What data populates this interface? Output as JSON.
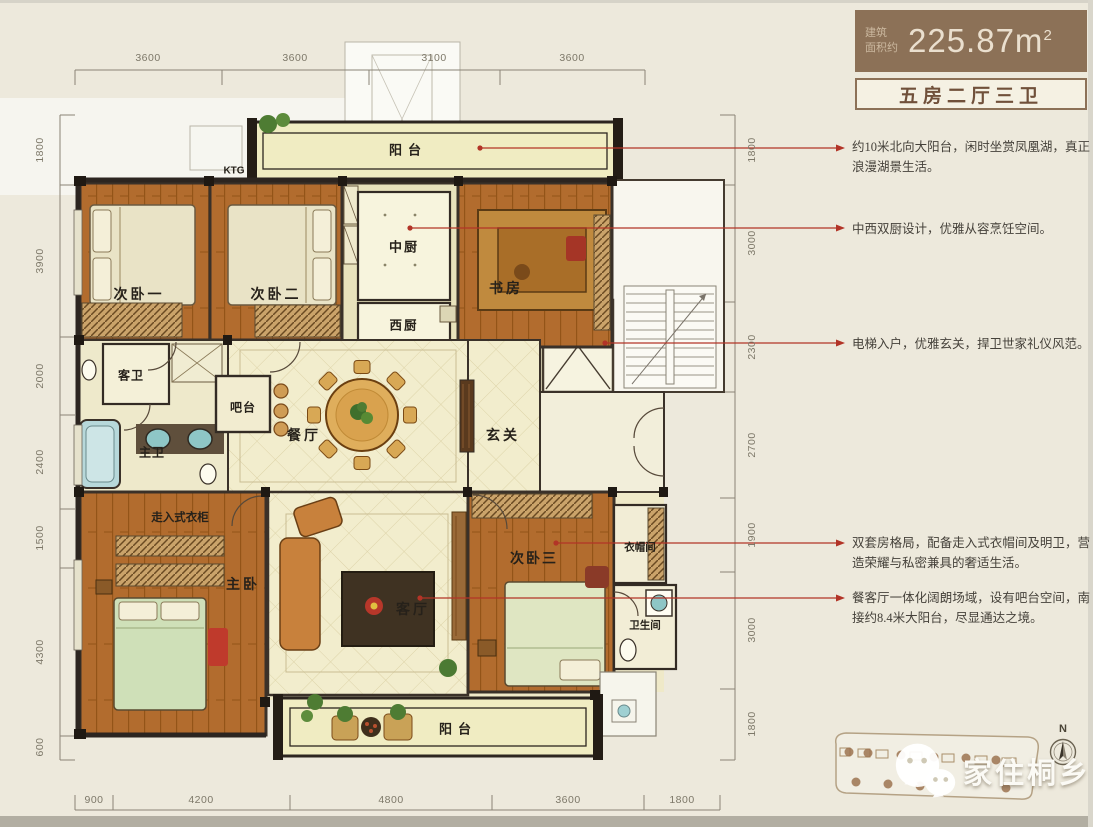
{
  "header": {
    "area_prefix_line1": "建筑",
    "area_prefix_line2": "面积约",
    "area_value": "225.87m",
    "area_unit_sup": "2",
    "unit_type": "五房二厅三卫",
    "badge_color": "#8c7157"
  },
  "annotations": [
    {
      "text": "约10米北向大阳台，闲时坐赏凤凰湖，真正浪漫湖景生活。"
    },
    {
      "text": "中西双厨设计，优雅从容烹饪空间。"
    },
    {
      "text": "电梯入户，优雅玄关，捍卫世家礼仪风范。"
    },
    {
      "text": "双套房格局，配备走入式衣帽间及明卫，营造荣耀与私密兼具的奢适生活。"
    },
    {
      "text": "餐客厅一体化阔朗场域，设有吧台空间，南接约8.4米大阳台，尽显通达之境。"
    }
  ],
  "rooms": {
    "balcony_top": "阳台",
    "ktg": "KTG",
    "bedroom2_1": "次卧一",
    "bedroom2_2": "次卧二",
    "kitchen_cn": "中厨",
    "kitchen_west": "西厨",
    "study": "书房",
    "guest_bath": "客卫",
    "bar": "吧台",
    "dining": "餐厅",
    "foyer": "玄关",
    "master_bath": "主卫",
    "walkin_closet": "走入式衣柜",
    "master_bedroom": "主卧",
    "living": "客厅",
    "bedroom3": "次卧三",
    "cloakroom": "衣帽间",
    "bath3": "卫生间",
    "balcony_bottom": "阳台"
  },
  "dims": {
    "top": [
      "3600",
      "3600",
      "3100",
      "3600"
    ],
    "bottom": [
      "900",
      "4200",
      "4800",
      "3600",
      "1800"
    ],
    "left": [
      "1800",
      "3900",
      "2000",
      "2400",
      "1500",
      "4300",
      "600"
    ],
    "right": [
      "1800",
      "3000",
      "2300",
      "2700",
      "1900",
      "3000",
      "1800"
    ]
  },
  "watermark": {
    "text": "家住桐乡"
  },
  "compass": {
    "north": "N"
  },
  "colors": {
    "leader_red": "#b23427",
    "wall_dark": "#2d2620",
    "wood_floor": "#b26c2e",
    "cream_floor": "#f2edcd"
  }
}
